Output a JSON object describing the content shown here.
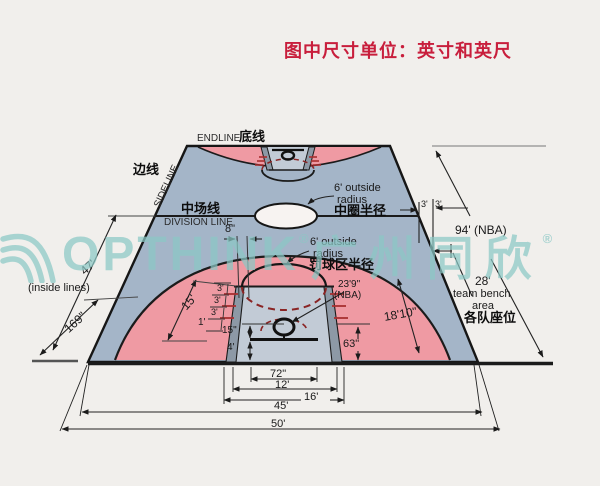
{
  "title": "图中尺寸单位：英寸和英尺",
  "palette": {
    "background": "#f1efec",
    "court_blue_gray": "#a4b5c8",
    "key_blue": "#c2cbd6",
    "three_point_pink": "#ef9aa3",
    "lane_strip_gray": "#8d99a6",
    "line_black": "#1b1b1b",
    "dash_red": "#8a2424",
    "title_red": "#c81e3c",
    "watermark_teal": "#8bc7c5",
    "center_circle_white": "#f7f3f1"
  },
  "watermark": {
    "brand": "OPTHINK",
    "reg1": "®",
    "brand_cn": "广州同欣",
    "reg2": "®"
  },
  "labels": {
    "endline_en": "ENDLINE",
    "endline_zh": "底线",
    "sideline_zh": "边线",
    "sideline_en": "SIDELINE",
    "midline_zh": "中场线",
    "midline_en": "DIVISION LINE",
    "center_radius_l1": "6' outside",
    "center_radius_l2": "radius",
    "center_radius_zh": "中圈半径",
    "ft_radius_l1": "6' outside",
    "ft_radius_l2": "radius",
    "ft_radius_zh": "罚球区半径",
    "dim_8in": "8\"",
    "dim_3a": "3'",
    "dim_3b": "3'",
    "dim_94": "94' (NBA)",
    "dim_28": "28'",
    "bench_l1": "team bench",
    "bench_l2": "area",
    "bench_zh": "各队座位",
    "dim_47": "47'",
    "inside_lines": "(inside lines)",
    "dim_169": "169\"",
    "dim_15ft": "15'",
    "hash_3a": "3'",
    "hash_3b": "3'",
    "hash_3c": "3'",
    "hash_1": "1'",
    "dim_15in": "15\"",
    "dim_4ft": "4'",
    "dim_63": "63\"",
    "dim_239": "23'9\"",
    "dim_239_nba": "(NBA)",
    "dim_1810": "18'10\"",
    "dim_72": "72\"",
    "dim_12": "12'",
    "dim_16": "16'",
    "dim_45": "45'",
    "dim_50": "50'"
  }
}
